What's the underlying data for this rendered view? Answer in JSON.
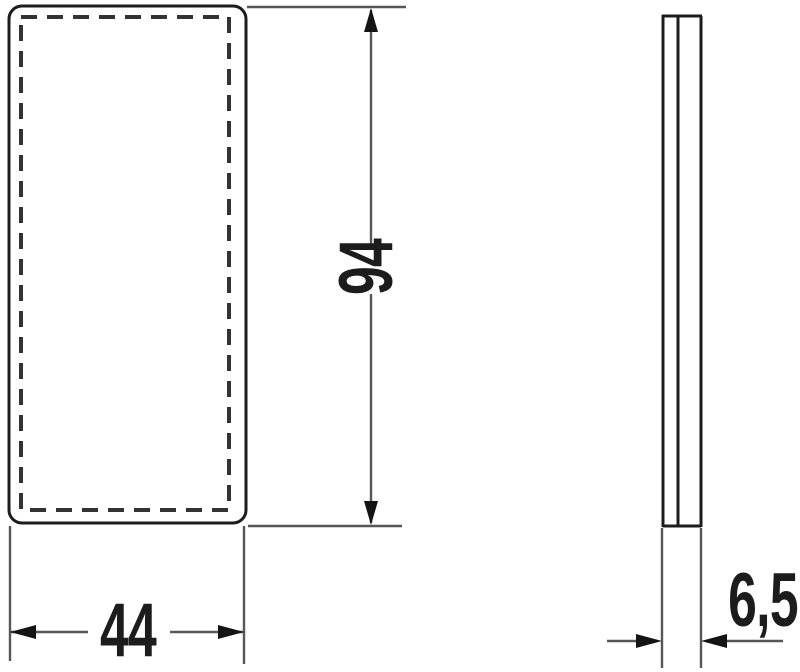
{
  "drawing": {
    "background": "#ffffff",
    "outline_color": "#1c1c1c",
    "dashed_outline_color": "#333333",
    "dimension_line_color": "#575757",
    "arrowhead_color": "#141414",
    "text_color": "#1c1c1c"
  },
  "dimensions": {
    "height_label": "94",
    "width_label": "44",
    "depth_label": "6,5"
  }
}
